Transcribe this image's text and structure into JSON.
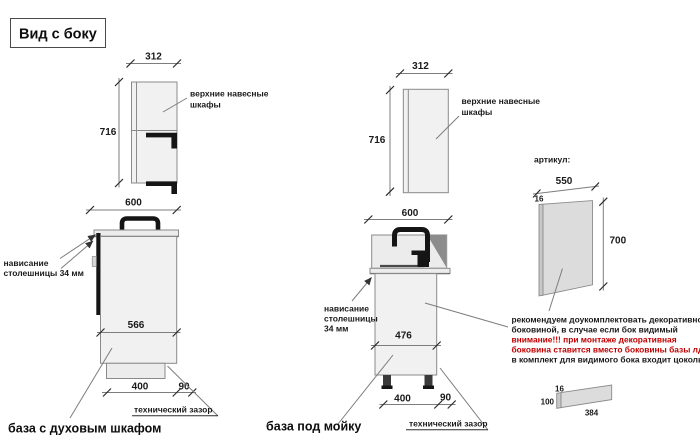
{
  "title": "Вид с боку",
  "colors": {
    "background": "#ffffff",
    "line_gray": "#8a8a8a",
    "text_black": "#1a1a1a",
    "warning_red": "#c00000",
    "cabinet_fill": "#f1f1f1",
    "panel_fill": "#dcdcdc",
    "hardware_black": "#151515"
  },
  "left_upper": {
    "width_dim": "312",
    "height_dim": "716",
    "label_line1": "верхние навесные",
    "label_line2": "шкафы"
  },
  "left_base": {
    "width_dim": "600",
    "overhang_line1": "нависание",
    "overhang_line2": "столешницы 34 мм",
    "depth_dim": "566",
    "plinth_dim": "400",
    "gap_dim": "90",
    "gap_label": "технический зазор",
    "caption": "база с духовым шкафом"
  },
  "mid_upper": {
    "width_dim": "312",
    "height_dim": "716",
    "label_line1": "верхние навесные",
    "label_line2": "шкафы"
  },
  "mid_base": {
    "width_dim": "600",
    "overhang_line1": "нависание",
    "overhang_line2": "столешницы",
    "overhang_line3": "34 мм",
    "depth_dim": "476",
    "plinth_dim": "400",
    "gap_dim": "90",
    "gap_label": "технический зазор",
    "caption": "база под мойку"
  },
  "side_panel": {
    "heading": "артикул:",
    "width_dim": "550",
    "thickness_dim": "16",
    "height_dim": "700",
    "note_line1": "рекомендуем доукомплектовать декоративной",
    "note_line2": "боковиной, в случае если бок видимый",
    "warn_line1": "внимание!!! при монтаже декоративная",
    "warn_line2": "боковина ставится вместо боковины базы лдсп",
    "note_line3": "в комплект для видимого бока входит цоколь:"
  },
  "plinth_panel": {
    "thickness_dim": "16",
    "height_dim": "100",
    "length_dim": "384"
  }
}
